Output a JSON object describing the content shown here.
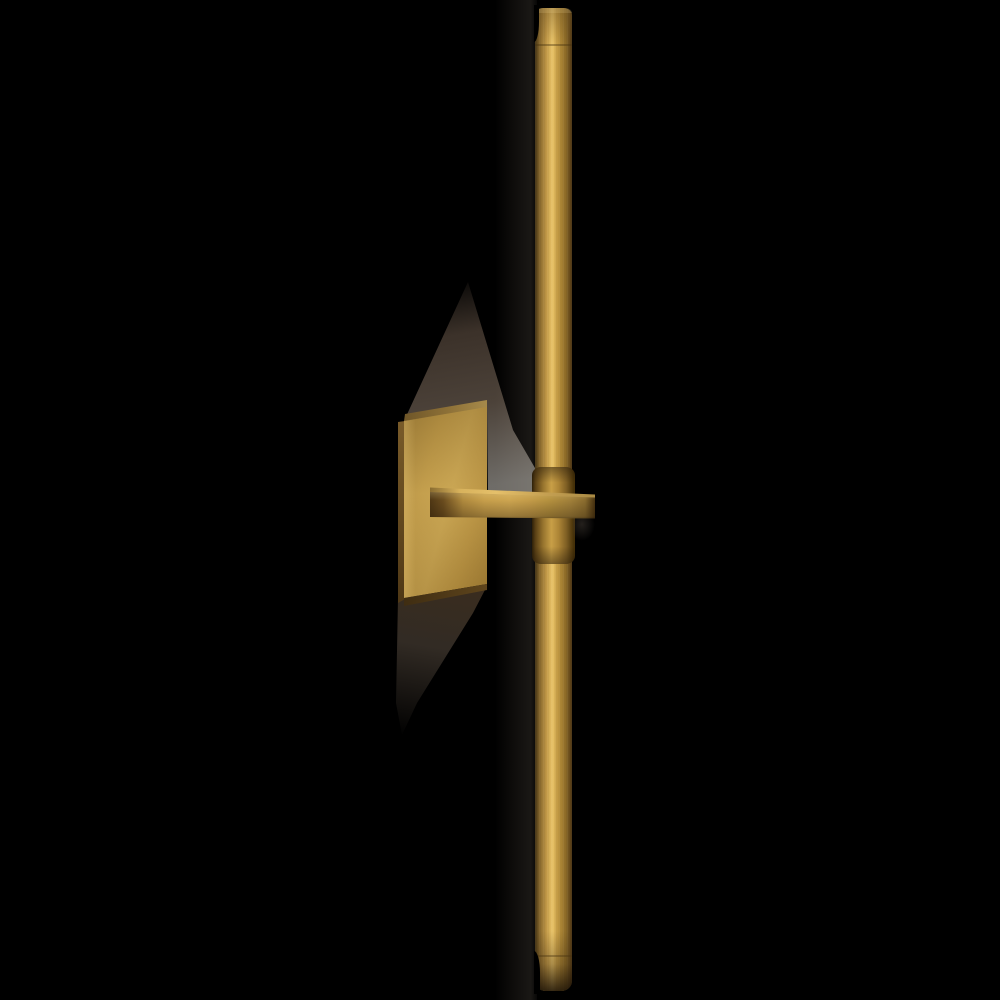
{
  "meta": {
    "type": "product-photo",
    "subject": "Brass linear wall sconce in side profile on a black background"
  },
  "canvas": {
    "width": 1000,
    "height": 1000
  },
  "palette": {
    "background": "#000000",
    "brass-dark": "#4f3a16",
    "brass-mid": "#b18a38",
    "brass-light": "#e3bd63",
    "brass-highlight": "#ecc76c",
    "shadow-brown": "#76624f",
    "shadow-gray": "#a5a19a"
  },
  "parts": {
    "rod": {
      "label": "vertical brass light rod with rounded end caps"
    },
    "backplate": {
      "label": "square brass wall-mount backplate"
    },
    "arm": {
      "label": "horizontal brass support arm"
    },
    "collar": {
      "label": "brass clamp collar around rod"
    },
    "shadow_upper": {
      "label": "soft wall shadow above backplate"
    },
    "shadow_lower": {
      "label": "soft wall shadow below backplate"
    },
    "glow": {
      "label": "faint warm light glow on wall beside rod"
    }
  }
}
